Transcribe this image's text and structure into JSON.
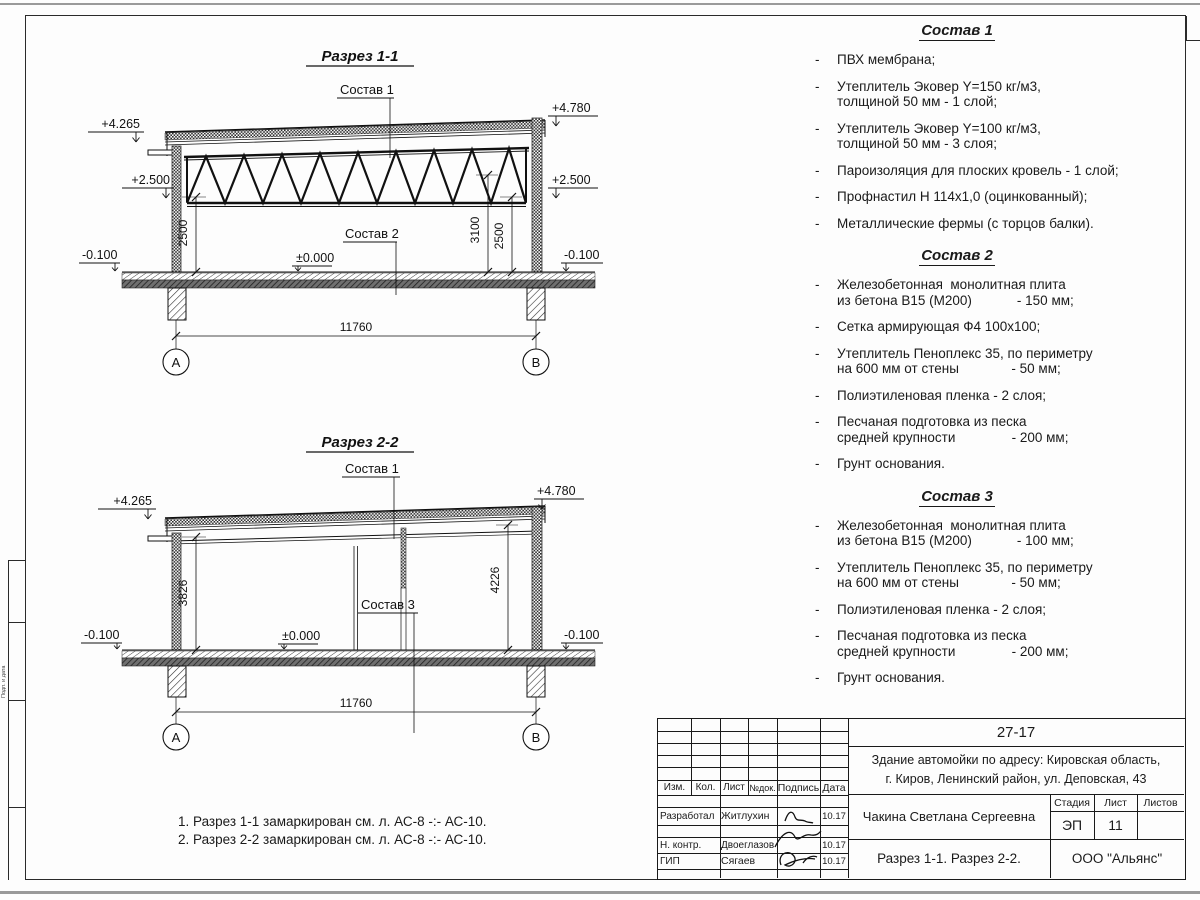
{
  "frame": {
    "side_text": "Подп. и дата"
  },
  "section1": {
    "title": "Разрез 1-1",
    "callout_top": "Состав 1",
    "callout_floor": "Состав 2",
    "elev_left_top": "+4.265",
    "elev_right_top": "+4.780",
    "elev_left_mid": "+2.500",
    "elev_right_mid": "+2.500",
    "elev_left_low": "-0.100",
    "elev_right_low": "-0.100",
    "elev_zero": "±0.000",
    "dim_left": "2500",
    "dim_mid": "3100",
    "dim_right": "2500",
    "dim_span": "11760",
    "axis_left": "А",
    "axis_right": "В"
  },
  "section2": {
    "title": "Разрез 2-2",
    "callout_top": "Состав 1",
    "callout_floor": "Состав 3",
    "elev_left_top": "+4.265",
    "elev_right_top": "+4.780",
    "elev_left_low": "-0.100",
    "elev_right_low": "-0.100",
    "elev_zero": "±0.000",
    "dim_left": "3826",
    "dim_right": "4226",
    "dim_span": "11760",
    "axis_left": "А",
    "axis_right": "В"
  },
  "notes": {
    "line1": "1. Разрез 1-1 замаркирован см. л. АС-8 -:- АС-10.",
    "line2": "2. Разрез 2-2 замаркирован см. л. АС-8 -:- АС-10."
  },
  "bullet": "-",
  "compositions": [
    {
      "title": "Состав 1",
      "items": [
        "ПВХ мембрана;",
        "Утеплитель Эковер Y=150 кг/м3,\nтолщиной 50 мм - 1 слой;",
        "Утеплитель Эковер Y=100 кг/м3,\nтолщиной 50 мм - 3 слоя;",
        "Пароизоляция для плоских кровель - 1 слой;",
        "Профнастил Н 114х1,0 (оцинкованный);",
        "Металлические фермы (с торцов балки)."
      ]
    },
    {
      "title": "Состав 2",
      "items": [
        "Железобетонная  монолитная плита\nиз бетона В15 (М200)            - 150 мм;",
        "Сетка армирующая Ф4 100х100;",
        "Утеплитель Пеноплекс 35, по периметру\nна 600 мм от стены              - 50 мм;",
        "Полиэтиленовая пленка - 2 слоя;",
        "Песчаная подготовка из песка\nсредней крупности               - 200 мм;",
        "Грунт основания."
      ]
    },
    {
      "title": "Состав 3",
      "items": [
        "Железобетонная  монолитная плита\nиз бетона В15 (М200)            - 100 мм;",
        "Утеплитель Пеноплекс 35, по периметру\nна 600 мм от стены              - 50 мм;",
        "Полиэтиленовая пленка - 2 слоя;",
        "Песчаная подготовка из песка\nсредней крупности               - 200 мм;",
        "Грунт основания."
      ]
    }
  ],
  "titleblock": {
    "code": "27-17",
    "project": "Здание автомойки по адресу: Кировская область,\nг. Киров, Ленинский район, ул. Деповская, 43",
    "col_izm": "Изм.",
    "col_kol": "Кол.",
    "col_list": "Лист",
    "col_ndok": "№док.",
    "col_podpis": "Подпись",
    "col_data": "Дата",
    "row1_role": "Разработал",
    "row1_name": "Житлухин",
    "row1_date": "10.17",
    "row2_role": "Н. контр.",
    "row2_name": "Двоеглазов",
    "row2_date": "10.17",
    "row3_role": "ГИП",
    "row3_name": "Сягаев",
    "row3_date": "10.17",
    "author": "Чакина Светлана Сергеевна",
    "stage_label": "Стадия",
    "sheet_label": "Лист",
    "sheets_label": "Листов",
    "stage": "ЭП",
    "sheet_no": "11",
    "sheets_total": "",
    "drawing_title": "Разрез 1-1. Разрез 2-2.",
    "company": "ООО \"Альянс\""
  }
}
